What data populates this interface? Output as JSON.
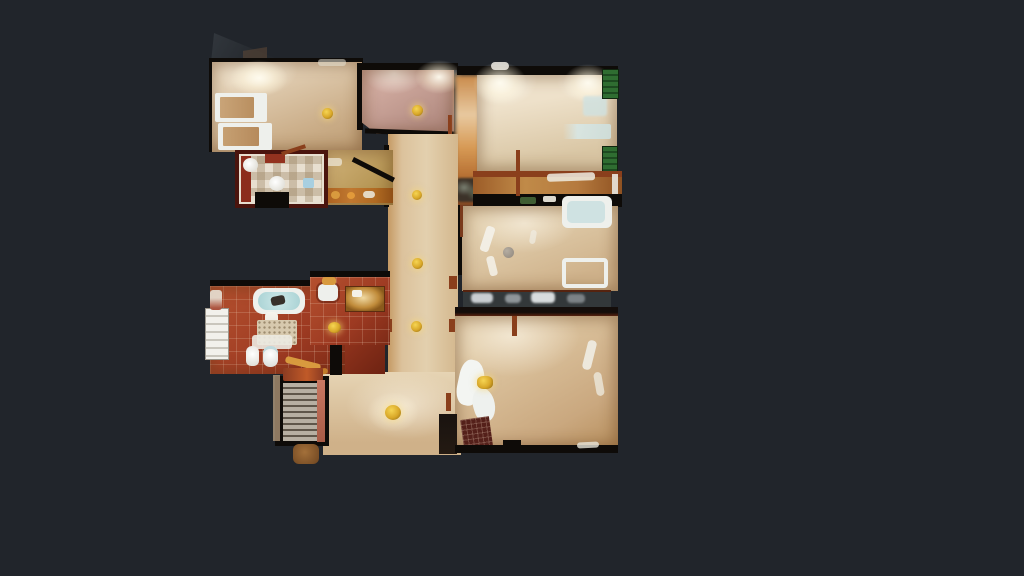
{
  "app": {
    "name": "3D dollhouse top-down floor plan scan",
    "view_mode": "floorplan-top-down",
    "background_color": "#21252b",
    "visible_text": "none"
  },
  "palette": {
    "bg": "#21252b",
    "woodPale": "#e9dcc4",
    "woodLight": "#dcc6a8",
    "woodMid": "#cbae89",
    "woodDark": "#b08a5e",
    "plank": "rgba(90,60,30,0.16)",
    "mauve": "#c7a096",
    "mauveDark": "#ae8378",
    "wallDark": "#0e0b08",
    "triangle": "#2c3137",
    "rust": "#8a3f1c",
    "rustBright": "#b35c28",
    "green": "#2f6d31",
    "greenDark": "#1d4a20",
    "gold": "#d9a829",
    "goldBright": "#f6d553",
    "goldDark": "#8a6410",
    "white": "#eef0ec",
    "paleBlue": "#cfe2e2",
    "glass": "#33383a",
    "glassLite": "#c9ced2",
    "stairTread": "#b7afa2",
    "stairLine": "#5f564a",
    "salmon": "#c97862",
    "kitchenFloor": "#c2a263",
    "counter": "#b06a22",
    "amber": "#d89a3e",
    "redTile": "#9d3a22",
    "redTileHi": "#b5512f",
    "redTileDark": "#7c2a16",
    "matRed": "#54201a"
  },
  "floorplan": {
    "regions": [
      {
        "id": "bedroom-top-left",
        "floor": "woodLight",
        "features": [
          "two white-framed beds",
          "gold ceiling light",
          "dark scan-hole triangle at top-left corner"
        ]
      },
      {
        "id": "bedroom-mauve",
        "floor": "mauve",
        "features": [
          "gold ceiling light",
          "chamfered lower-left corner"
        ]
      },
      {
        "id": "bedroom-top-right",
        "floor": "woodPale",
        "features": [
          "two ceiling light glows",
          "green shutters on right wall",
          "pale blue patches"
        ]
      },
      {
        "id": "balcony-band",
        "floor": "amber wood + dark strip",
        "features": [
          "rust railing line",
          "plant blobs",
          "green bits"
        ]
      },
      {
        "id": "living-room",
        "floor": "woodLight",
        "features": [
          "two white/pale-blue sofas",
          "round side table",
          "white light streaks",
          "glass clutter band at bottom"
        ]
      },
      {
        "id": "bedroom-bottom-right",
        "floor": "woodMid",
        "features": [
          "white sheet blob with gold object",
          "dark red grid mat",
          "chimney block",
          "white wall streaks"
        ]
      },
      {
        "id": "central-hallway",
        "floor": "woodLight",
        "features": [
          "three gold ceiling lights",
          "rust door jambs"
        ]
      },
      {
        "id": "kitchen",
        "floor": "kitchenFloor",
        "features": [
          "amber counter band with produce",
          "diagonal wall"
        ]
      },
      {
        "id": "small-bathroom",
        "floor": "checker tile",
        "features": [
          "two round white sinks",
          "blue item",
          "red tile border"
        ]
      },
      {
        "id": "master-bathroom",
        "floor": "redTile",
        "features": [
          "bathtub",
          "sink with bottles",
          "gold-lit vanity",
          "white shelf cabinet",
          "speckled rug",
          "towel",
          "toilet",
          "bidet"
        ]
      },
      {
        "id": "staircase",
        "floor": "stairTread",
        "features": [
          "gray treads",
          "salmon banister",
          "rust landing"
        ]
      },
      {
        "id": "lower-hallway",
        "floor": "woodLight",
        "features": [
          "gold chandelier"
        ]
      }
    ],
    "ceiling_lights_count": 6,
    "chandelier_count": 1
  }
}
